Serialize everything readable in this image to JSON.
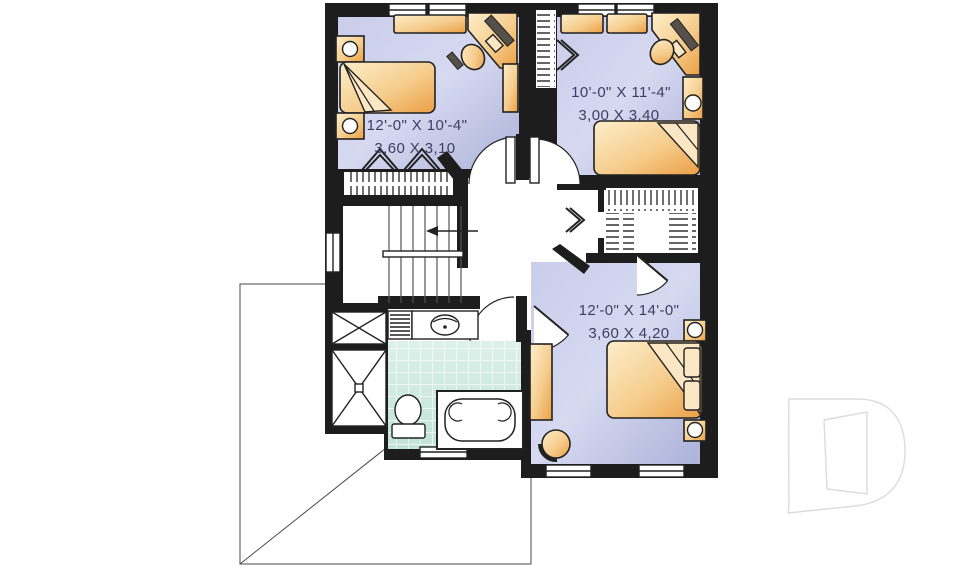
{
  "document": {
    "type": "house floor plan",
    "floor": "second floor"
  },
  "rooms": {
    "bedroom_top_left": {
      "imperial": "12'-0\" X 10'-4\"",
      "metric": "3,60 X 3,10"
    },
    "bedroom_top_right": {
      "imperial": "10'-0\" X 11'-4\"",
      "metric": "3,00 X 3,40"
    },
    "bedroom_bottom_right": {
      "imperial": "12'-0\" X 14'-0\"",
      "metric": "3,60 X 4,20"
    }
  },
  "colors": {
    "wall": "#1d1d1d",
    "room-light": "#d6d9f0",
    "room-dark": "#adb3da",
    "furniture-light": "#fdeecb",
    "furniture-dark": "#eb9f44",
    "tile-light": "#dcf0e9",
    "tile-dark": "#c2e3d8",
    "label": "#3a4060",
    "watermark": "#dcdcdc"
  },
  "watermark": {
    "icon": "d-logo"
  }
}
